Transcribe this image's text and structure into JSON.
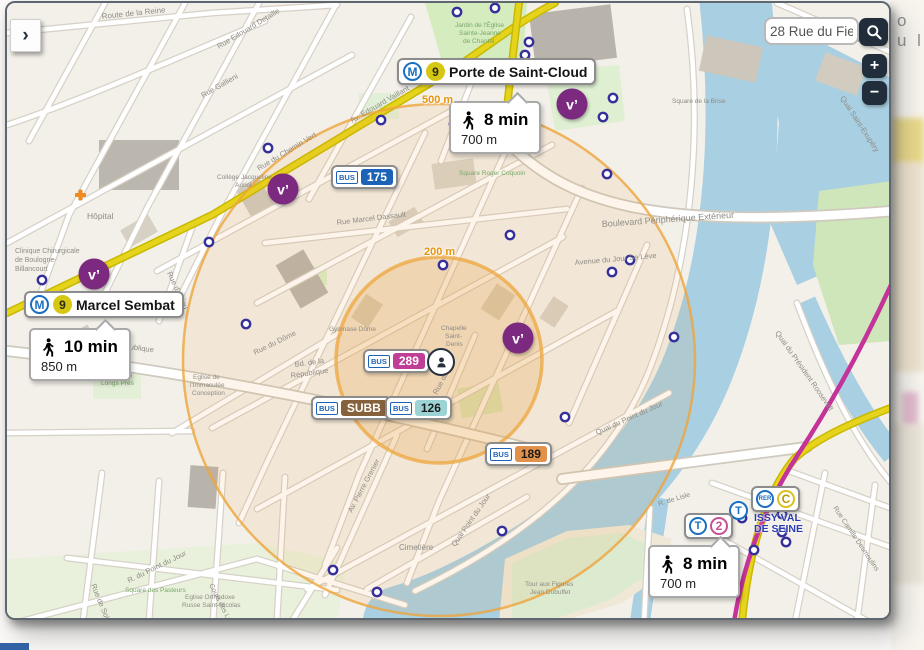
{
  "page_background": {
    "text_fragment": "o u l"
  },
  "search": {
    "value": "28 Rue du Fief"
  },
  "controls": {
    "expand_label": "›",
    "zoom_in_label": "+",
    "zoom_out_label": "−"
  },
  "logos": {
    "metro": "M",
    "tram": "T",
    "rer": "RER",
    "bus": "BUS",
    "velib": "v’"
  },
  "stations": {
    "porte_de_saint_cloud": {
      "line": "9",
      "name": "Porte de Saint-Cloud",
      "walk_time": "8 min",
      "walk_distance": "700 m"
    },
    "marcel_sembat": {
      "line": "9",
      "name": "Marcel Sembat",
      "walk_time": "10 min",
      "walk_distance": "850 m"
    },
    "issy": {
      "tram_line": "2",
      "rer_line": "C",
      "stop_letter": "T",
      "name_line1": "ISSY VAL",
      "name_line2": "DE SEINE",
      "walk_time": "8 min",
      "walk_distance": "700 m"
    }
  },
  "radius_rings": {
    "inner_label": "200 m",
    "outer_label": "500 m",
    "center_x": 432,
    "center_y": 357,
    "inner_r": 103,
    "outer_r": 256,
    "color": "#eda53c"
  },
  "bus_badges": [
    {
      "number": "175",
      "bg": "#1c63b7",
      "fg": "#ffffff",
      "x": 324,
      "y": 162
    },
    {
      "number": "289",
      "bg": "#c03e96",
      "fg": "#ffffff",
      "x": 356,
      "y": 346
    },
    {
      "number": "SUBB",
      "bg": "#85613c",
      "fg": "#ffffff",
      "x": 304,
      "y": 393
    },
    {
      "number": "126",
      "bg": "#9cd4d6",
      "fg": "#1a1a1a",
      "x": 378,
      "y": 393
    },
    {
      "number": "189",
      "bg": "#e2914a",
      "fg": "#1a1a1a",
      "x": 478,
      "y": 439
    }
  ],
  "velib_markers": [
    {
      "x": 565,
      "y": 101
    },
    {
      "x": 276,
      "y": 186
    },
    {
      "x": 87,
      "y": 271
    },
    {
      "x": 511,
      "y": 335
    }
  ],
  "poi_markers": [
    [
      450,
      9
    ],
    [
      488,
      5
    ],
    [
      522,
      39
    ],
    [
      518,
      52
    ],
    [
      596,
      114
    ],
    [
      606,
      95
    ],
    [
      261,
      145
    ],
    [
      374,
      117
    ],
    [
      447,
      121
    ],
    [
      436,
      262
    ],
    [
      503,
      232
    ],
    [
      239,
      321
    ],
    [
      35,
      277
    ],
    [
      202,
      239
    ],
    [
      600,
      171
    ],
    [
      623,
      257
    ],
    [
      605,
      269
    ],
    [
      667,
      334
    ],
    [
      558,
      414
    ],
    [
      495,
      528
    ],
    [
      326,
      567
    ],
    [
      370,
      589
    ],
    [
      735,
      515
    ],
    [
      775,
      511
    ],
    [
      775,
      529
    ],
    [
      779,
      539
    ],
    [
      747,
      547
    ],
    [
      725,
      555
    ]
  ],
  "map_labels": [
    {
      "t": "Route de la Reine",
      "x": 95,
      "y": 16,
      "r": -6,
      "s": 8
    },
    {
      "t": "Rue Edouard Detaille",
      "x": 212,
      "y": 46,
      "r": -31,
      "s": 7.5
    },
    {
      "t": "Rue Gallieni",
      "x": 196,
      "y": 95,
      "r": -30,
      "s": 7.5
    },
    {
      "t": "Av. Edouard Vaillant",
      "x": 345,
      "y": 120,
      "r": -30,
      "s": 7.5
    },
    {
      "t": "Rue du Chemin Vert",
      "x": 252,
      "y": 168,
      "r": -31,
      "s": 7.5
    },
    {
      "t": "Collège Jacqueline",
      "x": 210,
      "y": 176,
      "r": 0,
      "s": 6.5
    },
    {
      "t": "Auriol",
      "x": 228,
      "y": 184,
      "r": 0,
      "s": 6.5
    },
    {
      "t": "Hôpital",
      "x": 80,
      "y": 216,
      "r": 0,
      "s": 8.5
    },
    {
      "t": "Clinique Chirurgicale",
      "x": 8,
      "y": 250,
      "r": 0,
      "s": 7
    },
    {
      "t": "de Boulogne-",
      "x": 8,
      "y": 259,
      "r": 0,
      "s": 7
    },
    {
      "t": "Billancourt",
      "x": 8,
      "y": 268,
      "r": 0,
      "s": 7
    },
    {
      "t": "Rue Marcel Dassault",
      "x": 330,
      "y": 222,
      "r": -7,
      "s": 7.5
    },
    {
      "t": "Boulevard Périphérique Extérieur",
      "x": 595,
      "y": 224,
      "r": -4,
      "s": 9
    },
    {
      "t": "Avenue du Jour Se Lève",
      "x": 568,
      "y": 262,
      "r": -5,
      "s": 7.5
    },
    {
      "t": "Quai Saint-Exupéry",
      "x": 833,
      "y": 95,
      "r": 57,
      "s": 7.5
    },
    {
      "t": "Quai du Président Roosevelt",
      "x": 768,
      "y": 330,
      "r": 55,
      "s": 7.5
    },
    {
      "t": "Boulevard de la République",
      "x": 55,
      "y": 338,
      "r": 7,
      "s": 7.5
    },
    {
      "t": "Rue du Dôme",
      "x": 248,
      "y": 352,
      "r": -26,
      "s": 7.5
    },
    {
      "t": "Bd. de la",
      "x": 288,
      "y": 364,
      "r": -8,
      "s": 7.5
    },
    {
      "t": "République",
      "x": 284,
      "y": 375,
      "r": -8,
      "s": 7.5
    },
    {
      "t": "Gymnase Dôme",
      "x": 322,
      "y": 328,
      "r": 0,
      "s": 6.5
    },
    {
      "t": "Eglise de",
      "x": 186,
      "y": 376,
      "r": 0,
      "s": 6.5
    },
    {
      "t": "l'Immaculée",
      "x": 183,
      "y": 384,
      "r": 0,
      "s": 6.5
    },
    {
      "t": "Conception",
      "x": 185,
      "y": 392,
      "r": 0,
      "s": 6.5
    },
    {
      "t": "Chapelle",
      "x": 434,
      "y": 327,
      "r": 0,
      "s": 6.5
    },
    {
      "t": "Saint-",
      "x": 438,
      "y": 335,
      "r": 0,
      "s": 6.5
    },
    {
      "t": "Denis",
      "x": 439,
      "y": 343,
      "r": 0,
      "s": 6.5
    },
    {
      "t": "Rue du Fief",
      "x": 430,
      "y": 392,
      "r": -62,
      "s": 7.5
    },
    {
      "t": "Rue d'Anjou",
      "x": 160,
      "y": 270,
      "r": 65,
      "s": 7.5
    },
    {
      "t": "Cimetière",
      "x": 392,
      "y": 547,
      "r": 0,
      "s": 8
    },
    {
      "t": "Eglise Orthodoxe",
      "x": 178,
      "y": 596,
      "r": 0,
      "s": 6.5
    },
    {
      "t": "Russe Saint-Nicolas",
      "x": 175,
      "y": 604,
      "r": 0,
      "s": 6.5
    },
    {
      "t": "Square des Pasteurs",
      "x": 118,
      "y": 589,
      "r": 0,
      "s": 6.5,
      "c": "g"
    },
    {
      "t": "Rue de Solferino",
      "x": 84,
      "y": 582,
      "r": 68,
      "s": 7.5
    },
    {
      "t": "R. du Point du Jour",
      "x": 122,
      "y": 580,
      "r": -26,
      "s": 7.5
    },
    {
      "t": "Quai Point du Jour",
      "x": 448,
      "y": 544,
      "r": -55,
      "s": 7.5
    },
    {
      "t": "Quai du Point du Jour",
      "x": 590,
      "y": 432,
      "r": -24,
      "s": 7.5
    },
    {
      "t": "Tour aux Figures",
      "x": 518,
      "y": 583,
      "r": 0,
      "s": 6.5
    },
    {
      "t": "Jean Dubuffet",
      "x": 523,
      "y": 591,
      "r": 0,
      "s": 6.5
    },
    {
      "t": "Av. Pierre Grenier",
      "x": 345,
      "y": 510,
      "r": -62,
      "s": 7.5
    },
    {
      "t": "Square Roger Coquoin",
      "x": 452,
      "y": 172,
      "r": 0,
      "s": 6.5,
      "c": "g"
    },
    {
      "t": "Jardin de l'Église",
      "x": 448,
      "y": 24,
      "r": 0,
      "s": 6.5,
      "c": "g"
    },
    {
      "t": "Sainte-Jeanne",
      "x": 452,
      "y": 32,
      "r": 0,
      "s": 6.5,
      "c": "g"
    },
    {
      "t": "de Chantal",
      "x": 456,
      "y": 40,
      "r": 0,
      "s": 6.5,
      "c": "g"
    },
    {
      "t": "Square de la Brise",
      "x": 665,
      "y": 100,
      "r": 0,
      "s": 6.5
    },
    {
      "t": "Avenue de Versailles",
      "x": 796,
      "y": 22,
      "r": 17,
      "s": 7.5
    },
    {
      "t": "Square des",
      "x": 92,
      "y": 374,
      "r": 0,
      "s": 6.5,
      "c": "g"
    },
    {
      "t": "Longs Prés",
      "x": 94,
      "y": 382,
      "r": 0,
      "s": 6.5,
      "c": "g"
    },
    {
      "t": "Cours des Longs Prés",
      "x": 202,
      "y": 582,
      "r": 63,
      "s": 7
    },
    {
      "t": "Rue Camille Desmoulins",
      "x": 826,
      "y": 505,
      "r": 56,
      "s": 7
    },
    {
      "t": "R. de Lisle",
      "x": 652,
      "y": 503,
      "r": -17,
      "s": 7
    }
  ],
  "colors": {
    "water": "#a9cfe2",
    "land": "#f3f0e9",
    "park": "#d5ecbf",
    "metro_line9": "#d6c713",
    "metro_blue": "#1a6fc0",
    "tram_t2": "#c75096",
    "rer_c_yellow": "#dcc11e",
    "velib_purple": "#7b2a80",
    "radius_orange": "#eda53c",
    "road_yellow": "#e6d41c",
    "tram_line_magenta": "#c4339a",
    "ui_dark": "#222d3b"
  }
}
